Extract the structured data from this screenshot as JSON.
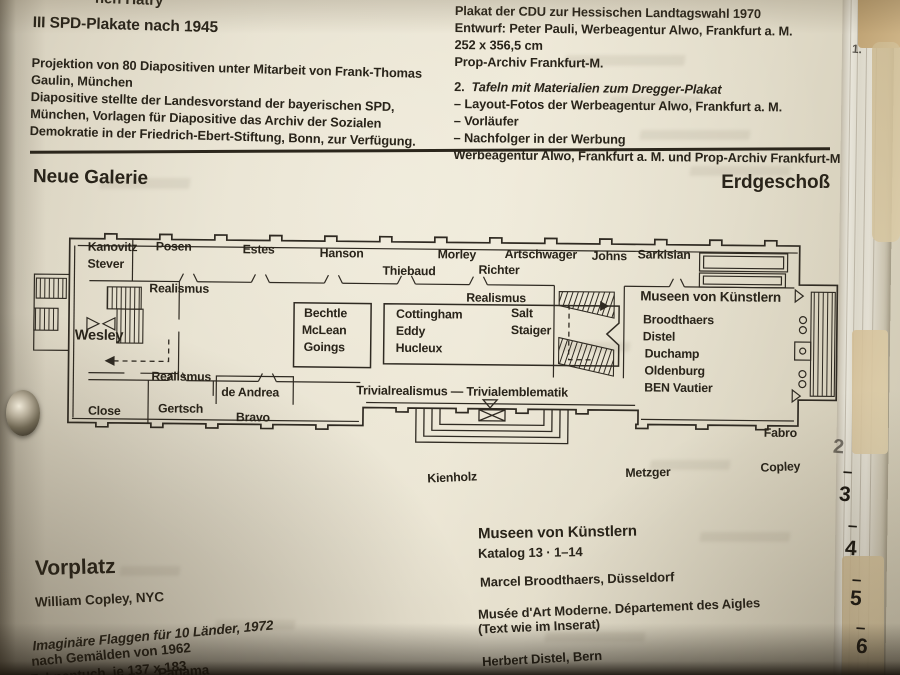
{
  "top_partial": "hen Hatry",
  "left_column": {
    "heading": "III SPD-Plakate nach 1945",
    "lines": [
      "Projektion von 80 Diapositiven unter Mitarbeit von Frank-Thomas",
      "Gaulin, München",
      "Diapositive stellte der Landesvorstand der bayerischen SPD,",
      "München, Vorlagen für Diapositive das Archiv der Sozialen",
      "Demokratie in der Friedrich-Ebert-Stiftung, Bonn, zur Verfügung."
    ]
  },
  "right_column": {
    "lines": [
      "Plakat der CDU zur Hessischen Landtagswahl 1970",
      "Entwurf: Peter Pauli, Werbeagentur Alwo, Frankfurt a. M.",
      "252 x 356,5 cm",
      "Prop-Archiv Frankfurt-M."
    ],
    "item2_number": "2.",
    "item2_title": "Tafeln mit Materialien zum Dregger-Plakat",
    "bullets": [
      "– Layout-Fotos der Werbeagentur Alwo, Frankfurt a. M.",
      "– Vorläufer",
      "– Nachfolger in der Werbung"
    ],
    "footer": "Werbeagentur Alwo, Frankfurt a. M. und Prop-Archiv Frankfurt-M."
  },
  "section": {
    "left": "Neue Galerie",
    "right": "Erdgeschoß"
  },
  "floorplan": {
    "labels": [
      {
        "t": "Kanovitz",
        "x": 58,
        "y": 17
      },
      {
        "t": "Stever",
        "x": 58,
        "y": 34
      },
      {
        "t": "Posen",
        "x": 126,
        "y": 16
      },
      {
        "t": "Estes",
        "x": 213,
        "y": 18
      },
      {
        "t": "Hanson",
        "x": 290,
        "y": 21
      },
      {
        "t": "Thiebaud",
        "x": 353,
        "y": 38
      },
      {
        "t": "Morley",
        "x": 408,
        "y": 21
      },
      {
        "t": "Richter",
        "x": 449,
        "y": 36
      },
      {
        "t": "Artschwager",
        "x": 475,
        "y": 20
      },
      {
        "t": "Johns",
        "x": 562,
        "y": 21
      },
      {
        "t": "Sarkisian",
        "x": 608,
        "y": 19
      },
      {
        "t": "Realismus",
        "x": 120,
        "y": 58
      },
      {
        "t": "Realismus",
        "x": 437,
        "y": 64
      },
      {
        "t": "Museen von Künstlern",
        "x": 611,
        "y": 60,
        "s": 13.5
      },
      {
        "t": "Broodthaers",
        "x": 614,
        "y": 84
      },
      {
        "t": "Distel",
        "x": 614,
        "y": 101
      },
      {
        "t": "Duchamp",
        "x": 616,
        "y": 118
      },
      {
        "t": "Oldenburg",
        "x": 616,
        "y": 135
      },
      {
        "t": "BEN Vautier",
        "x": 616,
        "y": 152
      },
      {
        "t": "Wesley",
        "x": 46,
        "y": 105,
        "s": 14.5
      },
      {
        "t": "Bechtle",
        "x": 275,
        "y": 81
      },
      {
        "t": "McLean",
        "x": 273,
        "y": 98
      },
      {
        "t": "Goings",
        "x": 275,
        "y": 115
      },
      {
        "t": "Cottingham",
        "x": 367,
        "y": 81
      },
      {
        "t": "Eddy",
        "x": 367,
        "y": 98
      },
      {
        "t": "Hucleux",
        "x": 367,
        "y": 115
      },
      {
        "t": "Salt",
        "x": 482,
        "y": 79
      },
      {
        "t": "Staiger",
        "x": 482,
        "y": 96
      },
      {
        "t": "Realismus",
        "x": 123,
        "y": 146
      },
      {
        "t": "de Andrea",
        "x": 193,
        "y": 161
      },
      {
        "t": "Close",
        "x": 60,
        "y": 181
      },
      {
        "t": "Gertsch",
        "x": 130,
        "y": 178
      },
      {
        "t": "Bravo",
        "x": 208,
        "y": 186
      },
      {
        "t": "Trivialrealismus — Trivialemblematik",
        "x": 328,
        "y": 158,
        "s": 12.5
      },
      {
        "t": "Fabro",
        "x": 736,
        "y": 196
      },
      {
        "t": "Kienholz",
        "x": 400,
        "y": 244,
        "r": -3
      },
      {
        "t": "Metzger",
        "x": 598,
        "y": 237,
        "r": -2
      },
      {
        "t": "Copley",
        "x": 733,
        "y": 230,
        "r": -3
      }
    ]
  },
  "vorplatz": {
    "heading": "Vorplatz",
    "artist": "William Copley, NYC",
    "work_title": "Imaginäre Flaggen für 10 Länder, 1972",
    "line2": "nach Gemälden von 1962",
    "line3": "Fahnentuch, je 137 x 183",
    "partial_bottom": "Panama"
  },
  "museen": {
    "heading": "Museen von Künstlern",
    "catalog": "Katalog 13 · 1–14",
    "artist1": "Marcel Broodthaers, Düsseldorf",
    "work1": "Musée d'Art Moderne. Département des Aigles",
    "note1": "(Text wie im Inserat)",
    "artist2": "Herbert Distel, Bern"
  },
  "fore_edge": {
    "marks": [
      {
        "t": "1.",
        "x": 852,
        "y": 42,
        "s": 12,
        "o": 0.7
      },
      {
        "t": "2",
        "x": 833,
        "y": 436,
        "s": 20,
        "o": 0.55
      },
      {
        "t": "–",
        "x": 843,
        "y": 462,
        "s": 17
      },
      {
        "t": "3",
        "x": 839,
        "y": 483,
        "s": 21
      },
      {
        "t": "–",
        "x": 848,
        "y": 516,
        "s": 17
      },
      {
        "t": "4",
        "x": 845,
        "y": 537,
        "s": 21
      },
      {
        "t": "–",
        "x": 852,
        "y": 570,
        "s": 17
      },
      {
        "t": "5",
        "x": 850,
        "y": 587,
        "s": 21
      },
      {
        "t": "–",
        "x": 856,
        "y": 618,
        "s": 17
      },
      {
        "t": "6",
        "x": 856,
        "y": 635,
        "s": 21
      }
    ]
  },
  "colors": {
    "ink": "#29241a",
    "paper": "#e8e2d1",
    "tape": "#cdb88f"
  }
}
